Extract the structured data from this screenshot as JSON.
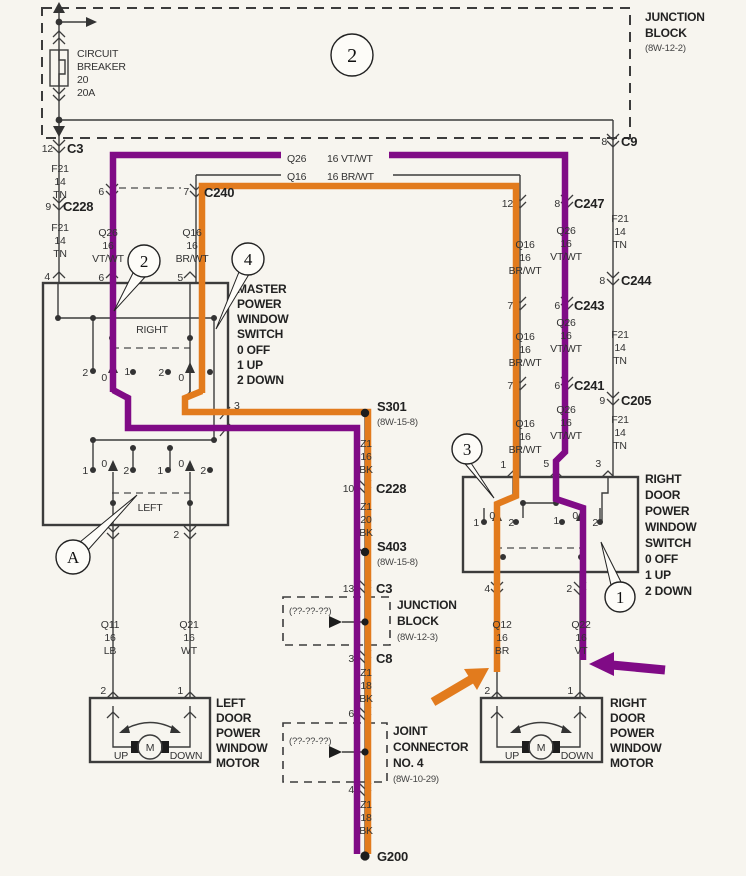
{
  "colors": {
    "purple": "#800b86",
    "orange": "#e27b1d",
    "wire": "#3c3c3c",
    "paper": "#f7f5ef"
  },
  "digits": {
    "zero": "0",
    "one": "1",
    "two": "2"
  },
  "top": {
    "junction_block": {
      "l1": "JUNCTION",
      "l2": "BLOCK",
      "ref": "(8W-12-2)"
    },
    "breaker": {
      "l1": "CIRCUIT",
      "l2": "BREAKER",
      "l3": "20",
      "l4": "20A"
    },
    "callout": "2",
    "c3": {
      "pin": "12",
      "name": "C3"
    },
    "c9": {
      "pin": "8",
      "name": "C9"
    }
  },
  "left": {
    "f21a": {
      "l1": "F21",
      "l2": "14",
      "l3": "TN"
    },
    "c228": {
      "pin": "9",
      "name": "C228"
    },
    "f21b": {
      "l1": "F21",
      "l2": "14",
      "l3": "TN"
    },
    "pin4": "4",
    "c240": {
      "pin_a": "6",
      "pin_b": "7",
      "name": "C240"
    },
    "q26v": {
      "l1": "Q26",
      "l2": "16",
      "l3": "VT/WT"
    },
    "q16v": {
      "l1": "Q16",
      "l2": "16",
      "l3": "BR/WT"
    },
    "pin6": "6",
    "pin5": "5"
  },
  "bus": {
    "q26": {
      "name": "Q26",
      "spec": "16 VT/WT"
    },
    "q16": {
      "name": "Q16",
      "spec": "16 BR/WT"
    }
  },
  "master": {
    "title": {
      "l1": "MASTER",
      "l2": "POWER",
      "l3": "WINDOW",
      "l4": "SWITCH",
      "l5": "0 OFF",
      "l6": "1 UP",
      "l7": "2 DOWN"
    },
    "right_label": "RIGHT",
    "left_label": "LEFT",
    "pin3": "3",
    "pin_bottom": "2",
    "callout_right": "2",
    "callout_window": "4",
    "callout_left": "A"
  },
  "mid": {
    "s301": {
      "name": "S301",
      "ref": "(8W-15-8)"
    },
    "z1a": {
      "l1": "Z1",
      "l2": "16",
      "l3": "BK"
    },
    "c228": {
      "pin": "10",
      "name": "C228"
    },
    "z1b": {
      "l1": "Z1",
      "l2": "20",
      "l3": "BK"
    },
    "s403": {
      "name": "S403",
      "ref": "(8W-15-8)"
    },
    "c3": {
      "pin": "13",
      "name": "C3"
    },
    "jb": {
      "unknown": "(??-??-??)",
      "l1": "JUNCTION",
      "l2": "BLOCK",
      "ref": "(8W-12-3)"
    },
    "c8": {
      "pin": "3",
      "name": "C8"
    },
    "z1c": {
      "l1": "Z1",
      "l2": "18",
      "l3": "BK"
    },
    "jc": {
      "pin_top": "6",
      "unknown": "(??-??-??)",
      "l1": "JOINT",
      "l2": "CONNECTOR",
      "l3": "NO. 4",
      "ref": "(8W-10-29)",
      "pin_bottom": "4"
    },
    "z1d": {
      "l1": "Z1",
      "l2": "18",
      "l3": "BK"
    },
    "g200": "G200"
  },
  "right": {
    "f21a": {
      "l1": "F21",
      "l2": "14",
      "l3": "TN"
    },
    "c244": {
      "pin": "8",
      "name": "C244"
    },
    "f21b": {
      "l1": "F21",
      "l2": "14",
      "l3": "TN"
    },
    "c205": {
      "pin": "9",
      "name": "C205"
    },
    "f21c": {
      "l1": "F21",
      "l2": "14",
      "l3": "TN"
    },
    "c247": {
      "pin_a": "12",
      "pin_b": "8",
      "name": "C247"
    },
    "q26a": {
      "l1": "Q26",
      "l2": "16",
      "l3": "VT/WT"
    },
    "q16a": {
      "l1": "Q16",
      "l2": "16",
      "l3": "BR/WT"
    },
    "c243": {
      "pin_a": "7",
      "pin_b": "6",
      "name": "C243"
    },
    "q26b": {
      "l1": "Q26",
      "l2": "16",
      "l3": "VT/WT"
    },
    "q16b": {
      "l1": "Q16",
      "l2": "16",
      "l3": "BR/WT"
    },
    "c241": {
      "pin_a": "7",
      "pin_b": "6",
      "name": "C241"
    },
    "q26c": {
      "l1": "Q26",
      "l2": "16",
      "l3": "VT/WT"
    },
    "q16c": {
      "l1": "Q16",
      "l2": "16",
      "l3": "BR/WT"
    }
  },
  "rswitch": {
    "pins_top": {
      "p1": "1",
      "p2": "5",
      "p3": "3"
    },
    "title": {
      "l1": "RIGHT",
      "l2": "DOOR",
      "l3": "POWER",
      "l4": "WINDOW",
      "l5": "SWITCH",
      "l6": "0 OFF",
      "l7": "1 UP",
      "l8": "2 DOWN"
    },
    "pins_bottom": {
      "p1": "4",
      "p2": "2"
    },
    "callout_top": "3",
    "callout_bottom": "1"
  },
  "rwires": {
    "q12": {
      "l1": "Q12",
      "l2": "16",
      "l3": "BR"
    },
    "q22": {
      "l1": "Q22",
      "l2": "16",
      "l3": "VT"
    }
  },
  "lwires": {
    "q11": {
      "l1": "Q11",
      "l2": "16",
      "l3": "LB"
    },
    "q21": {
      "l1": "Q21",
      "l2": "16",
      "l3": "WT"
    }
  },
  "lmotor": {
    "pin_a": "2",
    "pin_b": "1",
    "up": "UP",
    "down": "DOWN",
    "m": "M",
    "title": {
      "l1": "LEFT",
      "l2": "DOOR",
      "l3": "POWER",
      "l4": "WINDOW",
      "l5": "MOTOR"
    }
  },
  "rmotor": {
    "pin_a": "2",
    "pin_b": "1",
    "up": "UP",
    "down": "DOWN",
    "m": "M",
    "title": {
      "l1": "RIGHT",
      "l2": "DOOR",
      "l3": "POWER",
      "l4": "WINDOW",
      "l5": "MOTOR"
    }
  }
}
